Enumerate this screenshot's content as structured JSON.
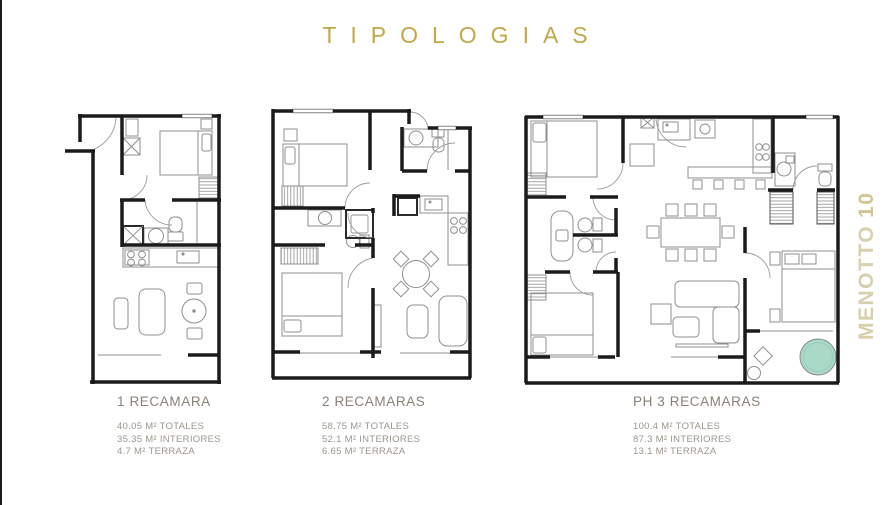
{
  "title": "TIPOLOGIAS",
  "watermark": {
    "brand": "MENOTTO",
    "number": "10"
  },
  "typologies": [
    {
      "name": "1 RECAMARA",
      "areas": {
        "totales": "40.05 M² TOTALES",
        "interiores": "35.35 M² INTERIORES",
        "terraza": "4.7 M² TERRAZA"
      }
    },
    {
      "name": "2 RECAMARAS",
      "areas": {
        "totales": "58.75 M² TOTALES",
        "interiores": "52.1 M² INTERIORES",
        "terraza": "6.65 M² TERRAZA"
      }
    },
    {
      "name": "PH 3 RECAMARAS",
      "areas": {
        "totales": "100.4 M² TOTALES",
        "interiores": "87.3 M² INTERIORES",
        "terraza": "13.1 M² TERRAZA"
      }
    }
  ],
  "colors": {
    "title_gold": "#c5a74b",
    "watermark_gold": "#d8cfae",
    "heading_gray": "#8a8177",
    "detail_gray": "#9c968d",
    "wall_black": "#1b1b1b",
    "furniture_gray": "#8f8f8f",
    "jacuzzi_teal": "#a9d9c7"
  }
}
